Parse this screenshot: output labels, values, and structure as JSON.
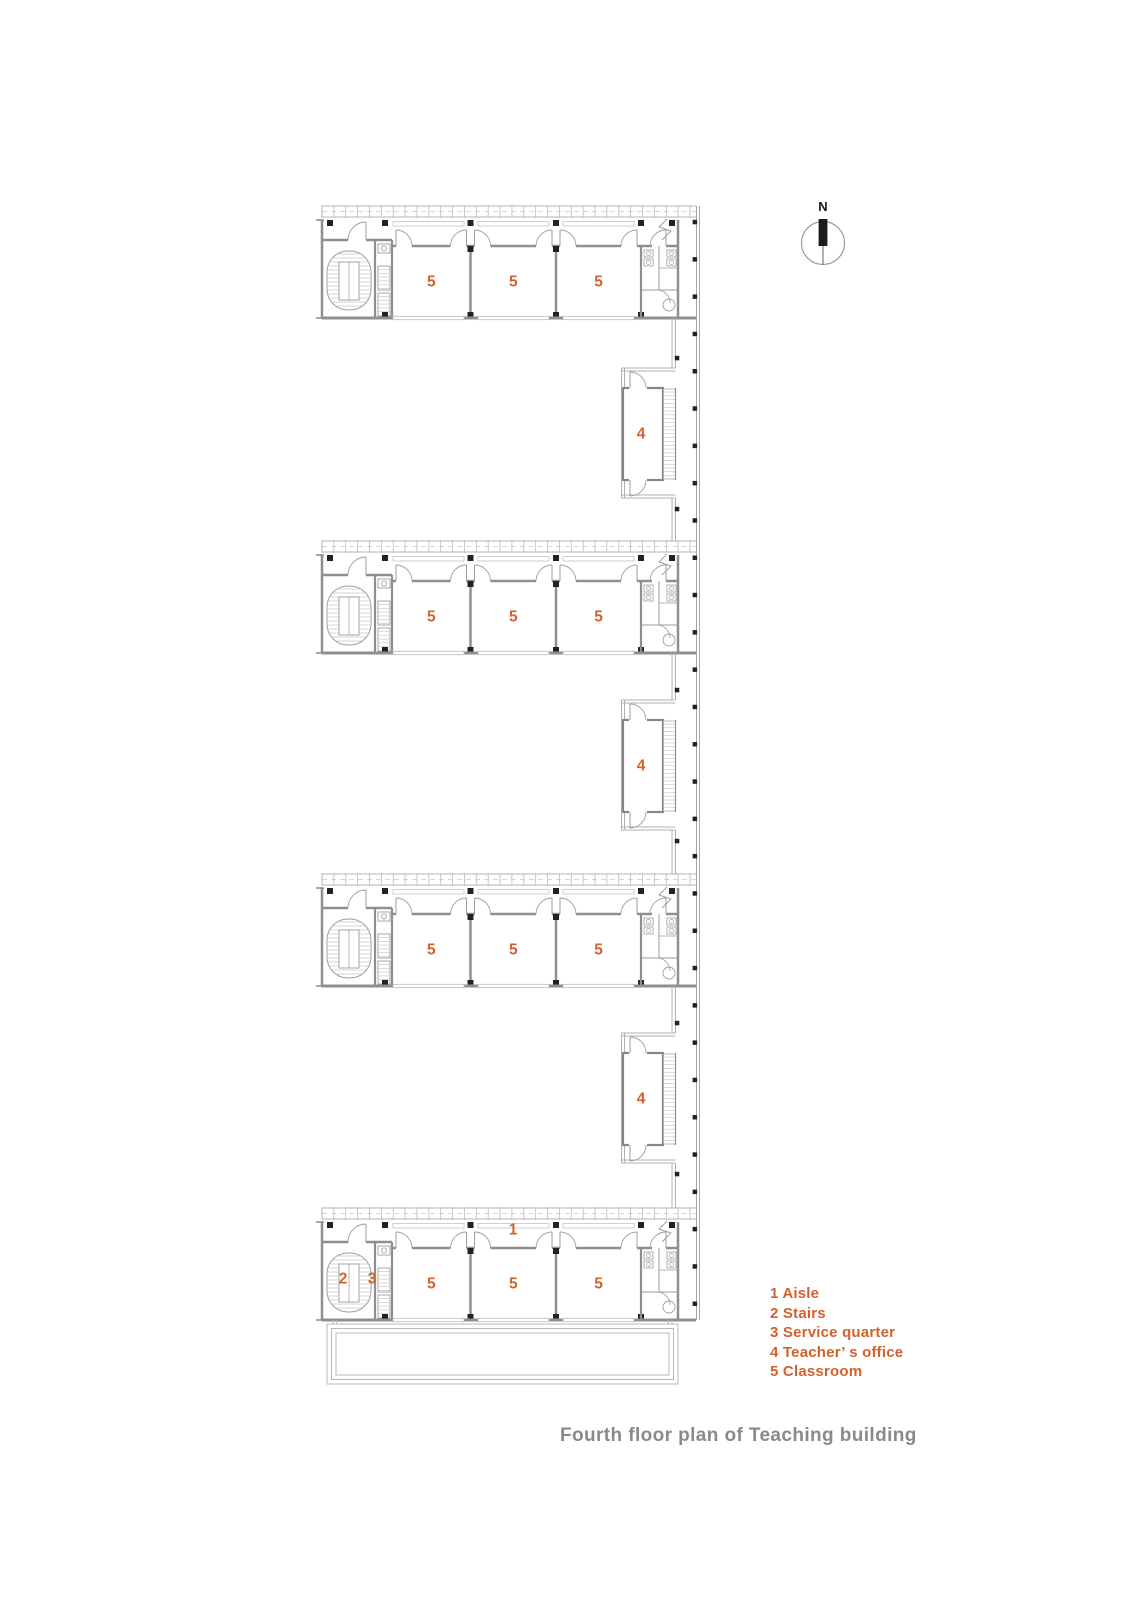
{
  "title": {
    "text": "Fourth floor plan of Teaching building"
  },
  "compass": {
    "label": "N"
  },
  "legend": {
    "items": [
      {
        "num": "1",
        "label": "Aisle"
      },
      {
        "num": "2",
        "label": "Stairs"
      },
      {
        "num": "3",
        "label": "Service quarter"
      },
      {
        "num": "4",
        "label": "Teacher’ s office"
      },
      {
        "num": "5",
        "label": "Classroom"
      }
    ]
  },
  "plan": {
    "wings": [
      {
        "name": "wing-1",
        "classroom_labels": [
          "5",
          "5",
          "5"
        ]
      },
      {
        "name": "wing-2",
        "classroom_labels": [
          "5",
          "5",
          "5"
        ]
      },
      {
        "name": "wing-3",
        "classroom_labels": [
          "5",
          "5",
          "5"
        ]
      },
      {
        "name": "wing-4",
        "classroom_labels": [
          "5",
          "5",
          "5"
        ],
        "aisle_label": "1",
        "stairs_label": "2",
        "service_label": "3"
      }
    ],
    "offices": [
      {
        "label": "4"
      },
      {
        "label": "4"
      },
      {
        "label": "4"
      }
    ]
  },
  "colors": {
    "accent_orange": "#d2622d",
    "wall_gray": "#8f8f8f",
    "line_light": "#b5b5b5",
    "fixture_gray": "#9d9d9d",
    "column_black": "#222222",
    "title_gray": "#8a8a8a"
  }
}
